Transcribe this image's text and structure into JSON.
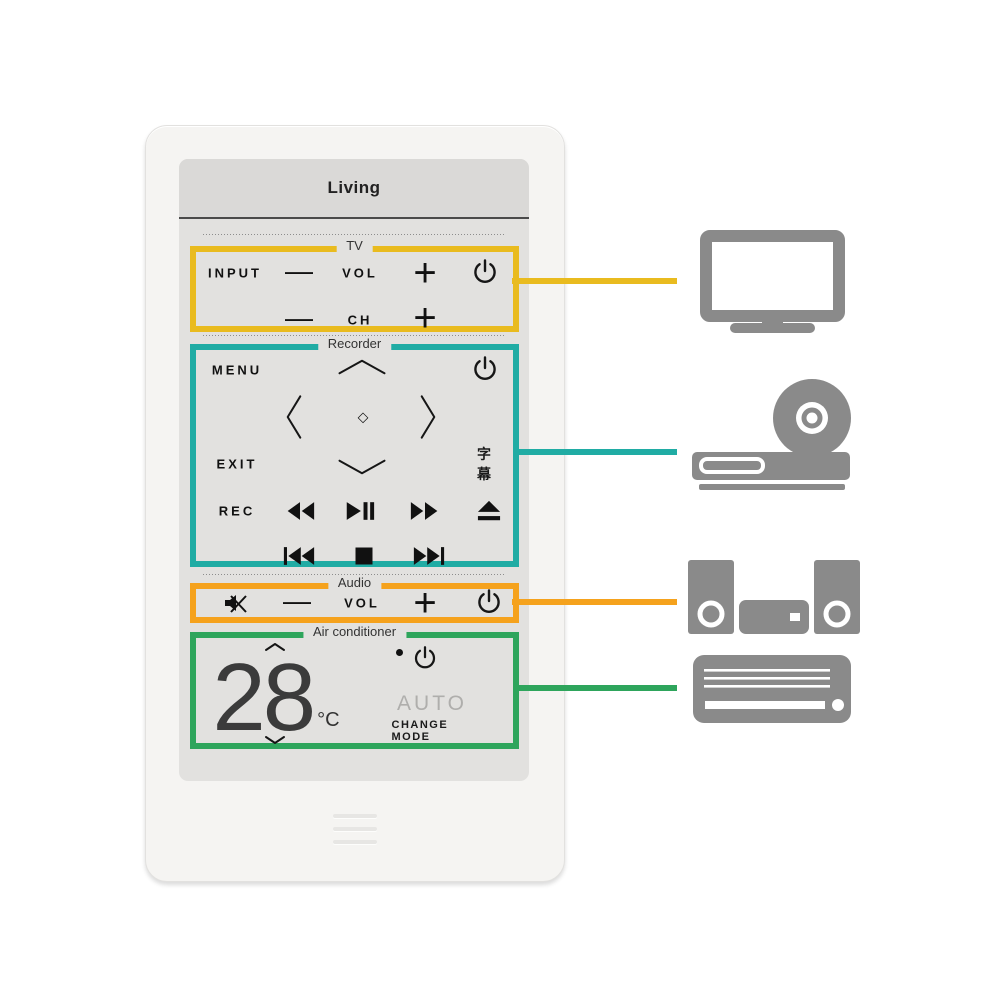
{
  "remote": {
    "title": "Living"
  },
  "colors": {
    "tv-accent": "#E9BB1F",
    "recorder-accent": "#20ACA4",
    "audio-accent": "#F5A21D",
    "ac-accent": "#2EA55C",
    "device-icon": "#8A8A8A",
    "screen-bg": "#E2E1DF",
    "header-bg": "#DAD9D7",
    "body-bg": "#F5F4F2"
  },
  "sections": {
    "tv": {
      "label": "TV",
      "buttons": {
        "input": "INPUT",
        "vol": "VOL",
        "ch": "CH",
        "minus": "—",
        "plus": "+"
      }
    },
    "recorder": {
      "label": "Recorder",
      "buttons": {
        "menu": "MENU",
        "exit": "EXIT",
        "rec": "REC",
        "subtitle": "字幕",
        "ok": "◇"
      }
    },
    "audio": {
      "label": "Audio",
      "buttons": {
        "vol": "VOL",
        "minus": "—",
        "plus": "+"
      }
    },
    "ac": {
      "label": "Air conditioner",
      "temperature": "28",
      "unit": "°C",
      "mode": "AUTO",
      "change_mode": "CHANGE MODE"
    }
  },
  "icons": [
    "power-icon",
    "mute-icon",
    "rewind-icon",
    "play-pause-icon",
    "fast-forward-icon",
    "eject-icon",
    "previous-track-icon",
    "stop-icon",
    "next-track-icon",
    "chevron-up-icon",
    "chevron-down-icon",
    "chevron-left-icon",
    "chevron-right-icon",
    "tv-icon",
    "disc-recorder-icon",
    "audio-system-icon",
    "air-conditioner-icon"
  ],
  "callouts": [
    {
      "section": "tv",
      "device": "television",
      "color": "#E9BB1F"
    },
    {
      "section": "recorder",
      "device": "disc-recorder",
      "color": "#20ACA4"
    },
    {
      "section": "audio",
      "device": "audio-system",
      "color": "#F5A21D"
    },
    {
      "section": "ac",
      "device": "air-conditioner",
      "color": "#2EA55C"
    }
  ]
}
